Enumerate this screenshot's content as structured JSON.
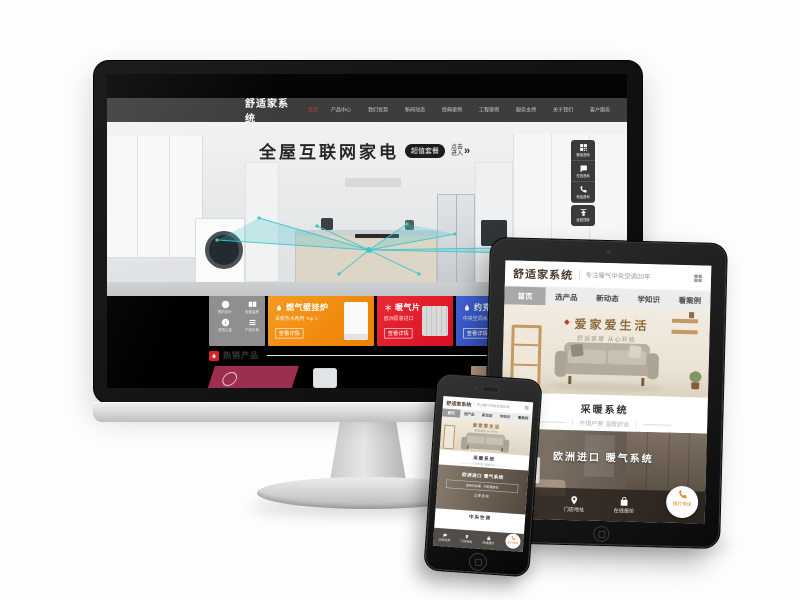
{
  "colors": {
    "accent_red": "#e5232e",
    "accent_orange": "#f08519",
    "accent_blue": "#3a57c4",
    "maroon": "#9d2f4e",
    "teal": "#3cc7cd",
    "gold": "#8f6f42",
    "nav_dark": "#3d3d3d"
  },
  "shared": {
    "logo": "舒适家系统",
    "tagline": "专注暖气中央空调20年",
    "nav": [
      "首页",
      "选产品",
      "新动态",
      "学知识",
      "看案例"
    ],
    "banner_title": "爱家爱生活",
    "banner_sub": "舒适家居 从心开始",
    "heating_title": "采暖系统",
    "heating_sub": "不惧严寒 温暖舒适",
    "photo_title": "欧洲进口 暖气系统",
    "bottom_nav": [
      "立即咨询",
      "门店地址",
      "在线报价",
      "拨打电话"
    ]
  },
  "desktop": {
    "nav": [
      "首页",
      "产品中心",
      "我们优势",
      "新闻动态",
      "经典案例",
      "工程案例",
      "服务支持",
      "关于我们",
      "客户服务"
    ],
    "hero": {
      "title": "全屋互联网家电",
      "badge": "超值套餐",
      "cta1": "点击",
      "cta2": "进入",
      "arrow": "»"
    },
    "quick_icons": [
      "预约设计",
      "免费量房",
      "门店查询",
      "资质认证",
      "产品手册",
      "安装施工"
    ],
    "tiles": {
      "boiler": {
        "title": "燃气壁挂炉",
        "sub": "采暖热水两用 Top 1",
        "btn": "查看详情"
      },
      "radiator": {
        "title": "暖气片",
        "sub": "欧洲原装进口",
        "btn": "查看详情"
      },
      "york": {
        "title": "约克",
        "sub": "中央空调水系统",
        "btn": "查看详情"
      }
    },
    "hot_title": "热销产品",
    "widget": [
      "微信咨询",
      "在线咨询",
      "电话咨询",
      "返回顶部"
    ]
  },
  "phone_extra": {
    "card_desc": "即热式采暖 · 节能更舒适",
    "card_cta": "立即咨询",
    "section2": "中央空调"
  }
}
